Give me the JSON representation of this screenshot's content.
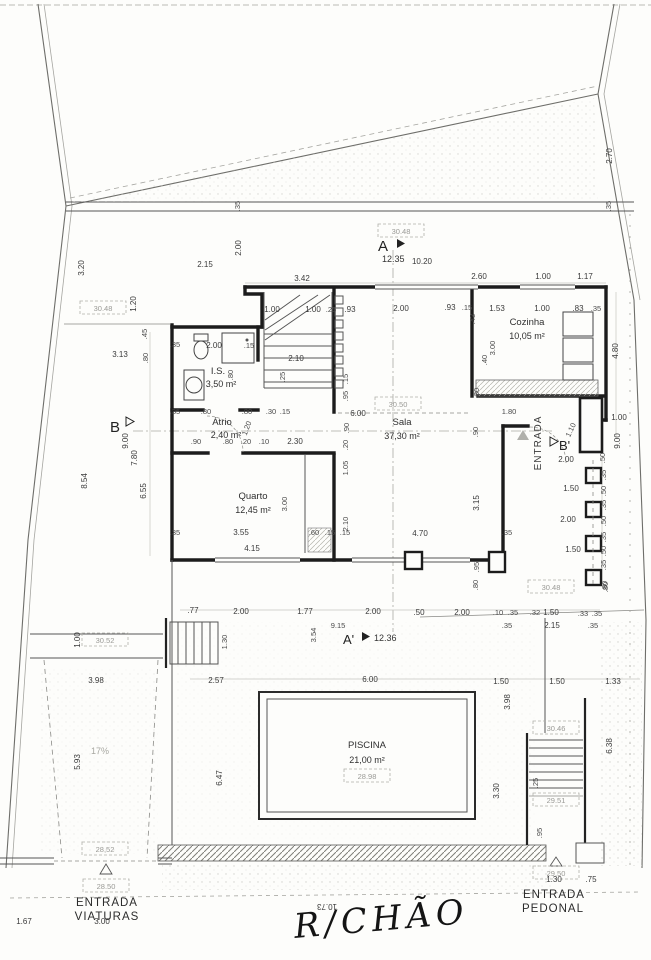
{
  "title": {
    "handwritten": "R/CHÃO"
  },
  "rooms": {
    "sala": {
      "name": "Sala",
      "area": "37,30 m²"
    },
    "quarto": {
      "name": "Quarto",
      "area": "12,45 m²"
    },
    "cozinha": {
      "name": "Cozinha",
      "area": "10,05 m²"
    },
    "is": {
      "name": "I.S.",
      "area": "3,50 m²"
    },
    "atrio": {
      "name": "Átrio",
      "area": "2,40 m²"
    },
    "piscina": {
      "name": "PISCINA",
      "area": "21,00 m²"
    }
  },
  "markers": {
    "a": {
      "label": "A",
      "value": "12.35"
    },
    "a_prime": {
      "label": "A'",
      "value": "12.36"
    },
    "b": {
      "label": "B"
    },
    "b_prime": {
      "label": "B'"
    }
  },
  "entrances": {
    "interior": "ENTRADA",
    "viaturas": {
      "line1": "ENTRADA",
      "line2": "VIATURAS"
    },
    "pedonal": {
      "line1": "ENTRADA",
      "line2": "PEDONAL"
    }
  },
  "ramp": "17%",
  "levels": [
    "30.48",
    "30.48",
    "30.50",
    "30.48",
    "30.52",
    "28,52",
    "28.50",
    "28.98",
    "30.46",
    "29.51",
    "29.50"
  ],
  "dims": [
    "2.70",
    ".35",
    ".35",
    "2.00",
    "2.15",
    "3.42",
    "10.20",
    "2.60",
    "1.00",
    "1.17",
    "1.00",
    "1.00",
    ".25",
    ".93",
    "2.00",
    ".93",
    ".15",
    "1.53",
    "1.00",
    ".83",
    ".35",
    "3.20",
    "1.20",
    ".45",
    "3.13",
    ".80",
    "2.10",
    ".25",
    ".15",
    ".95",
    ".35",
    "2.00",
    ".15",
    ".80",
    ".43",
    "3.00",
    ".40",
    "4.80",
    ".30",
    ".90",
    ".20",
    "1.05",
    "6.00",
    "9.00",
    "7.80",
    "8.54",
    "6.55",
    ".35",
    ".80",
    ".80",
    ".30",
    ".15",
    ".90",
    ".80",
    ".20",
    ".10",
    "2.30",
    "1.20",
    "3.00",
    "3.55",
    "4.15",
    ".60",
    ".15",
    ".15",
    "2.10",
    ".35",
    "3.15",
    "4.70",
    ".35",
    ".95",
    "1.80",
    ".90",
    "2.00",
    "1.50",
    "2.00",
    "1.50",
    "1.00",
    "9.00",
    ".50",
    ".35",
    ".50",
    ".35",
    ".50",
    ".35",
    ".50",
    ".35",
    ".80",
    "1.10",
    ".77",
    "2.00",
    "1.77",
    "2.00",
    ".50",
    "2.00",
    ".10",
    ".35",
    ".32",
    "1.50",
    ".33",
    ".35",
    ".35",
    "2.15",
    ".35",
    "9.15",
    "3.54",
    ".80",
    ".80",
    "1.30",
    "2.57",
    "6.00",
    "1.50",
    "1.50",
    "1.33",
    "3.98",
    "6.47",
    "3.30",
    "6.38",
    ".25",
    ".95",
    "1.30",
    ".75",
    "1.00",
    "3.98",
    "5.93",
    "1.67",
    "3.00",
    "10.73"
  ]
}
